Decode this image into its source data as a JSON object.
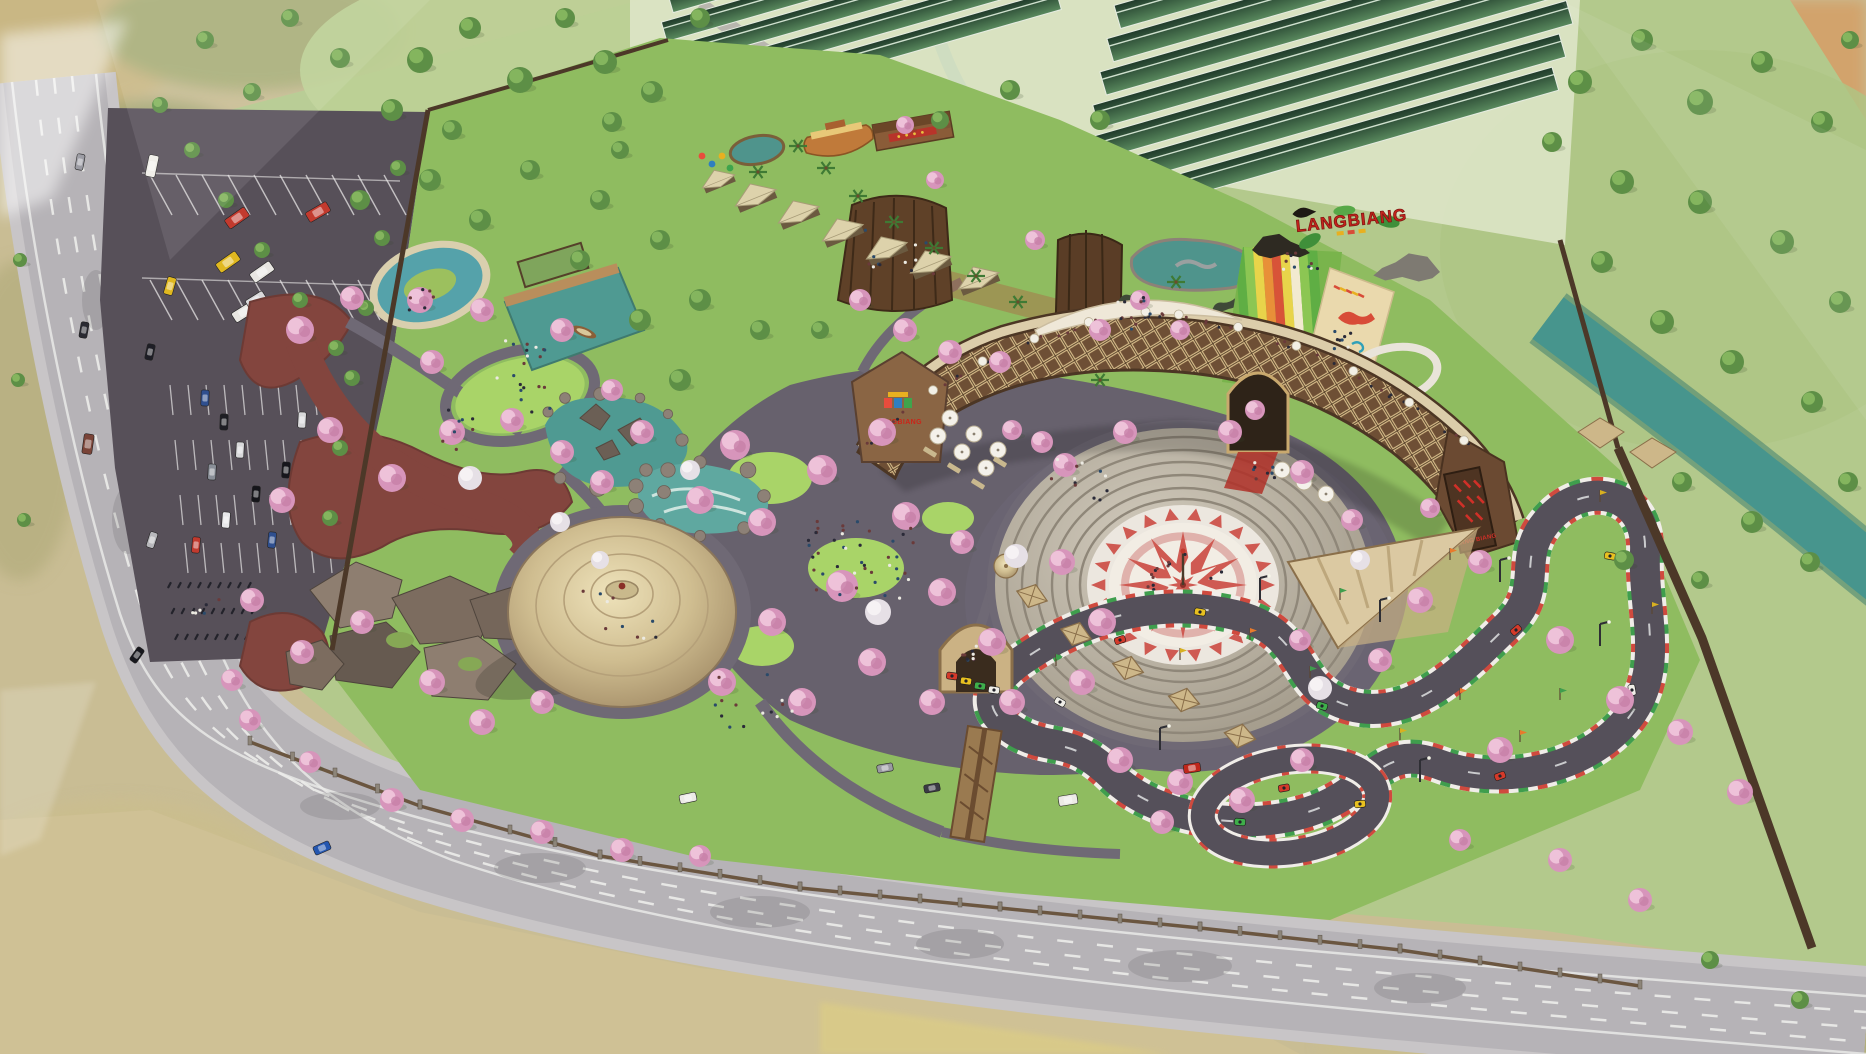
{
  "scene": {
    "type": "aerial-3d-render",
    "subject": "Bird's-eye architectural rendering of the LANGBIANG eco-tourism theme park masterplan",
    "signs": {
      "hill_sign": "LANGBIANG",
      "building_logo": "LANGBIANG",
      "building_banner": "LANG BIANG"
    },
    "features": {
      "main_road": "curved public road with dashed lane lines along left and bottom edges",
      "parking_lot": "angled bus bays and car stalls with motorbike rows",
      "cherry_blossom_garden": "lawns, winding stone paths and pink blossom trees",
      "red_flower_beds": "winding maroon planting bands",
      "lazy_river_pool": "looped teal pool with island",
      "pier_pond": "teal pond with timber boardwalk, pergola and rowing boat",
      "rock_pond": "pond with sculpted dragon rocks",
      "rapids_pond": "white-water rock pool",
      "conical_pavilion": "large round thatched-roof pavilion",
      "rock_garden": "boulder mound with blossom trees",
      "amphitheater": "sunken circular theatre with red-and-white compass mosaic and dancers",
      "arc_building": "curved timber-lattice hotel block with rooftop terrace crowd and umbrellas",
      "entrance_arch": "pointed timber gate with red carpet",
      "rainbow_slide": "striped downhill dry slide with dinosaur statues",
      "dino_mat_art": "cream mat painted with colorful dinosaur figures",
      "dino_pond": "rock-edged pond with marine-dinosaur statue",
      "cabins_row": "row of gable glamping cabins",
      "ark_playhouse": "boat-shaped play structure and long house",
      "greenhouses": "two banks of parallel dark-green greenhouse roofs",
      "kart_track": "looping go-kart circuit with red/white/green curbs, karts and pennant flags",
      "kart_gate": "arched start gate with queued karts",
      "covered_bridge": "timber covered bridge over the track",
      "shade_canopy": "large triangular patterned canopy",
      "river": "teal river crossing the meadow at the right",
      "perimeter_fence": "stone-post fence along the road and timber fence on the east"
    },
    "colors": {
      "road": "#b6b3b7",
      "sidewalk": "#c8c5c7",
      "parking": "#575059",
      "field_green": "#b3c98c",
      "park_green": "#8fbc60",
      "lawn": "#a9d468",
      "plaza_pave": "#67616d",
      "path": "#6f6975",
      "water": "#4f9a92",
      "river": "#47958d",
      "pool": "#55a2aa",
      "blossom": "#dc9cc0",
      "blossom_light": "#eec2d9",
      "foliage": "#6a9c4e",
      "red_soil": "#83453e",
      "thatch": "#d8c89e",
      "wood": "#7c5a3d",
      "lattice": "#d8bd8a",
      "dark_roof": "#4c3624",
      "track": "#55505a",
      "curb_red": "#d04a3e",
      "curb_green": "#3f9e4d",
      "kart_red": "#d43a2a",
      "kart_yellow": "#e8c020",
      "kart_green": "#3fae4a",
      "compass_red": "#cf5a52",
      "stone": "#b7afa2",
      "sign_red": "#c4231c",
      "leaf_green": "#3f8f3a",
      "greenhouse": "#2e4e3a",
      "fence": "#4c3828",
      "terrain_tan": "#cfc195",
      "terrain_olive": "#9aa86c",
      "slide_green": "#79b44c",
      "slide_yellow": "#e8d44a",
      "slide_orange": "#e89038",
      "slide_red": "#d85338",
      "canopy_cream": "#efe8d8"
    }
  }
}
